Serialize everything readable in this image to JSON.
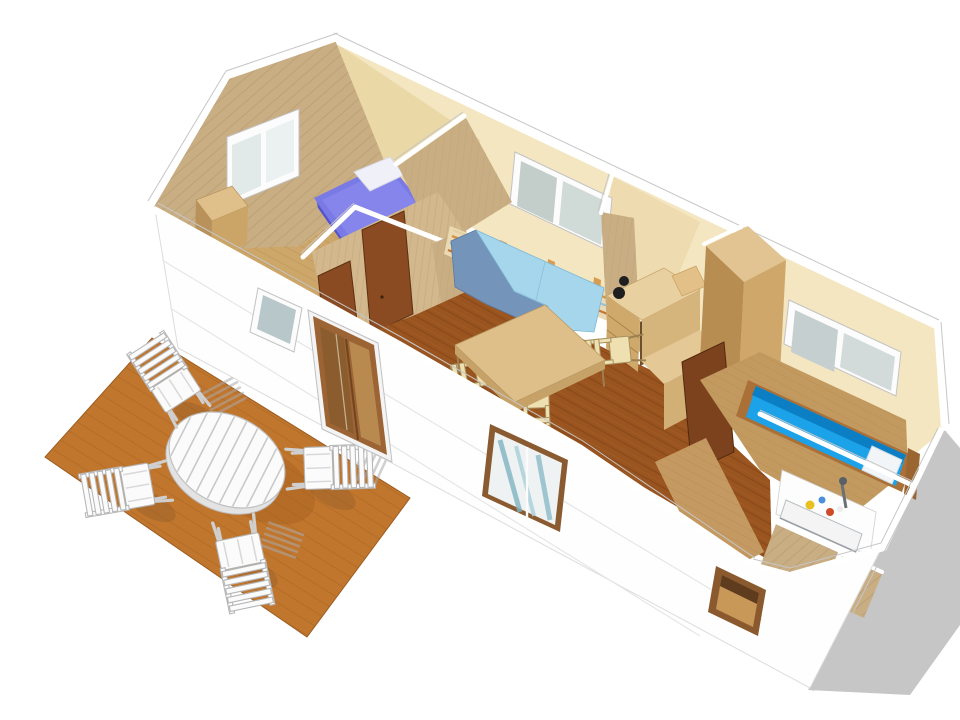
{
  "scene": {
    "type": "3d-cutaway-floorplan-render",
    "subject": "mobile-home-interior-with-terrace",
    "rooms": [
      {
        "name": "bedroom-left",
        "furniture": [
          "purple-double-bed",
          "white-pillow",
          "closet",
          "gable-window"
        ]
      },
      {
        "name": "hallway",
        "furniture": [
          "wood-door",
          "wood-door"
        ]
      },
      {
        "name": "living-dining",
        "furniture": [
          "blue-corner-sofa",
          "striped-wainscot",
          "dining-table",
          "dining-chairs",
          "back-window"
        ]
      },
      {
        "name": "kitchen-nook",
        "furniture": [
          "desk-counter",
          "desk-chair",
          "black-lamp",
          "cabinet",
          "wardrobe"
        ]
      },
      {
        "name": "bedroom-right",
        "furniture": [
          "blue-single-bed",
          "white-pillow",
          "back-window"
        ]
      },
      {
        "name": "bathroom",
        "furniture": [
          "sink-counter",
          "faucet",
          "toiletries",
          "wood-half-walls"
        ]
      }
    ],
    "outdoor": {
      "name": "terrace-deck",
      "furniture": [
        "oval-slatted-table",
        "garden-chair",
        "garden-chair",
        "garden-chair",
        "garden-chair"
      ],
      "shadows": [
        "table-shadow",
        "chair-shadows",
        "building-shadow"
      ]
    },
    "counts": {
      "garden_chairs": 4,
      "dining_chairs": 3,
      "front_wall_windows": 3,
      "back_wall_windows": 2,
      "gable_windows": 1,
      "sliding_doors": 1,
      "interior_doors": 3
    }
  },
  "colors": {
    "background": "#ffffff",
    "shadow": "#c6c6c6",
    "deck": "#c1762e",
    "wall_cream": "#f3e6c1",
    "wood_wall": "#c9ae83",
    "floor_light": "#cda76a",
    "floor_dark": "#99541f",
    "floor_mid": "#c29a5f",
    "bed_purple": "#7a7ae6",
    "bed_blue": "#1ba2e8",
    "sofa_dark": "#7494ba",
    "sofa_light": "#a6d6ec",
    "door_brown": "#8a4a22",
    "kitchen_wood": "#e8d0a0",
    "table_wood": "#dfbf89",
    "chair_wood": "#eee0b0",
    "outdoor_furniture": "#fbfbfb",
    "window_glass": "#c8d2cf",
    "trim_white": "#ffffff"
  }
}
